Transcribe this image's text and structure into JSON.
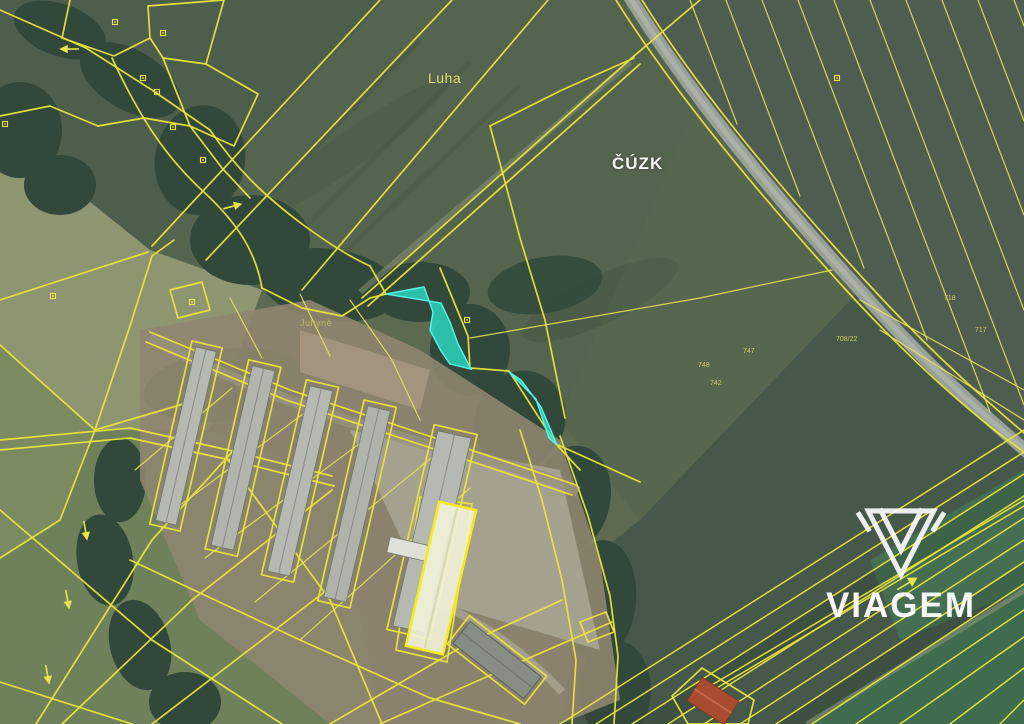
{
  "map": {
    "kind": "cadastral parcel map over aerial imagery",
    "locality_label": "Luha",
    "stream_label": "Juhyně",
    "agency_watermark": "ČÚZK",
    "parcel_numbers": [
      {
        "text": "708/22"
      },
      {
        "text": "748"
      },
      {
        "text": "747"
      },
      {
        "text": "742"
      },
      {
        "text": "718"
      },
      {
        "text": "717"
      }
    ]
  },
  "logo": {
    "brand": "VIAGEM",
    "icon": "gem-icon"
  },
  "colors": {
    "cadastral_line": "#e9e43c",
    "highlight_parcel_fill": "#2bdcc6",
    "highlight_parcel_stroke": "#55f3e0",
    "highlight_building_fill": "#f3f2d8",
    "highlight_building_stroke": "#f6ec15",
    "watermark_text": "#ffffff"
  }
}
